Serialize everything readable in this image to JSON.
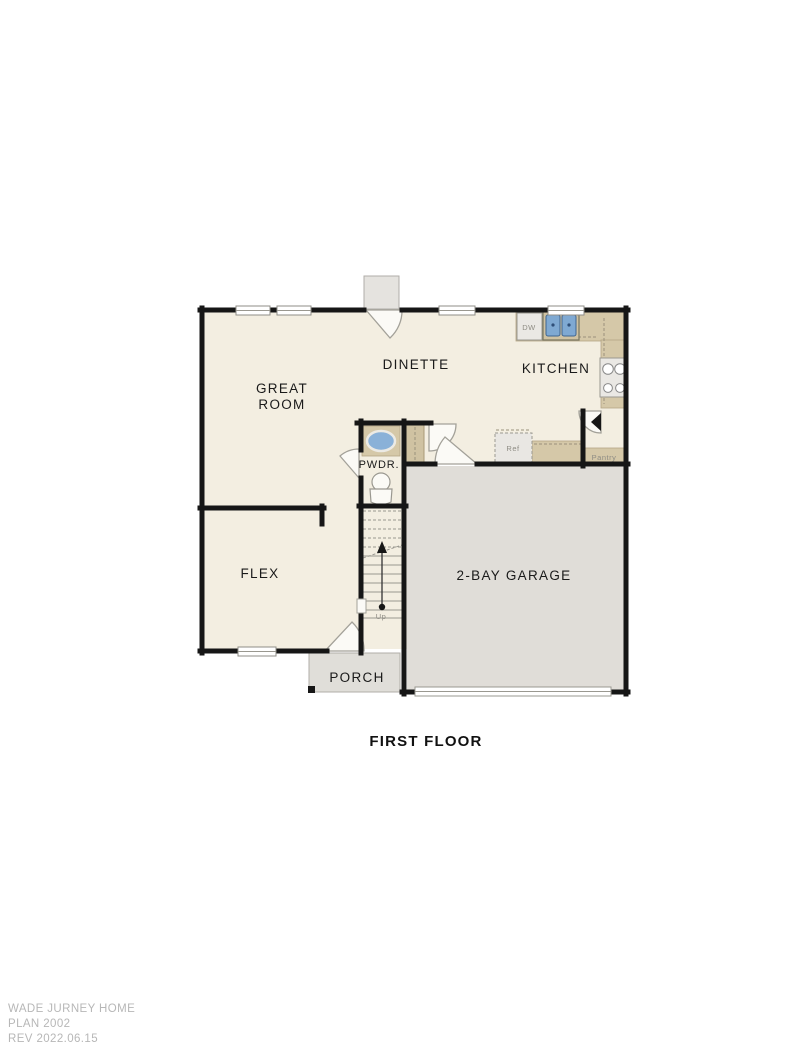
{
  "colors": {
    "floor": "#f3eee1",
    "garage_floor": "#e0ddd8",
    "porch_floor": "#e0ded9",
    "wall": "#161616",
    "counter": "#d5c8a8",
    "sink_basin": "#7fa9d2",
    "watermark_text": "#b7b7b7"
  },
  "plan": {
    "title": "FIRST FLOOR",
    "rooms": {
      "great_room": {
        "line1": "GREAT",
        "line2": "ROOM"
      },
      "dinette": {
        "label": "DINETTE"
      },
      "kitchen": {
        "label": "KITCHEN"
      },
      "powder": {
        "label": "PWDR."
      },
      "flex": {
        "label": "FLEX"
      },
      "garage": {
        "label": "2-BAY GARAGE"
      },
      "porch": {
        "label": "PORCH"
      },
      "pantry": {
        "label": "Pantry"
      }
    },
    "fixtures": {
      "dishwasher": "DW",
      "refrigerator": "Ref",
      "stairs_direction": "Up"
    }
  },
  "footer": {
    "lines": [
      "WADE JURNEY HOME",
      "PLAN 2002",
      "REV 2022.06.15"
    ]
  }
}
